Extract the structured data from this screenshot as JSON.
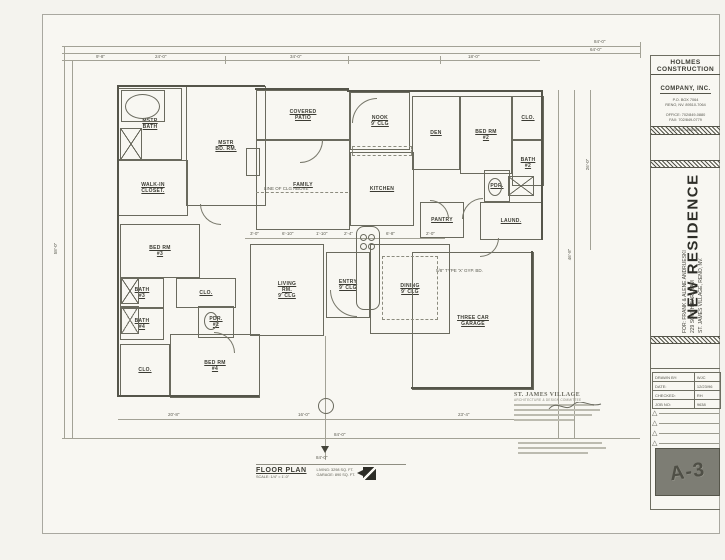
{
  "title_block": {
    "company_line1": "HOLMES CONSTRUCTION",
    "company_line2": "COMPANY, INC.",
    "addr1": "P.O. BOX 7064",
    "addr2": "RENO, NV. 89510-7064",
    "phone1": "OFFICE: 702/849-0880",
    "phone2": "FAX: 702/849-0779",
    "license": "NV. LIC. #38109",
    "project": "NEW RESIDENCE",
    "client": "FOR: FRANK & ALENE ANDRUESKI",
    "site_address": "229 SOUTH EARLHAM",
    "site_city": "ST. JAMES VILLAGE, RENO, NV.",
    "info_rows": [
      {
        "label": "DRAWN BY:",
        "value": "WJC"
      },
      {
        "label": "DATE:",
        "value": "12/23/96"
      },
      {
        "label": "CHECKED:",
        "value": "RH"
      },
      {
        "label": "JOB NO:",
        "value": "9638"
      }
    ],
    "sheet_number": "A-3"
  },
  "plan_title": {
    "name": "FLOOR PLAN",
    "scale": "SCALE: 1/4\" = 1'-0\"",
    "living_area": "LIVING:  3298 SQ. FT.",
    "garage_area": "GARAGE:  890 SQ. FT."
  },
  "stamp": {
    "title": "ST. JAMES VILLAGE",
    "subtitle": "ARCHITECTURE & DESIGN COMMITTEE"
  },
  "colors": {
    "ink": "#55554a",
    "paper": "#f8f7f2",
    "sheet_box": "#7d7d74"
  },
  "plan": {
    "rooms": [
      {
        "n": "mstr-bath",
        "t": "MSTR|BATH",
        "x": 118,
        "y": 88,
        "w": 62,
        "h": 70
      },
      {
        "n": "walk-in-closet",
        "t": "WALK-IN|CLOSET.",
        "x": 118,
        "y": 160,
        "w": 68,
        "h": 54
      },
      {
        "n": "mstr-bd-rm",
        "t": "MSTR|BD. RM.",
        "x": 186,
        "y": 86,
        "w": 78,
        "h": 118
      },
      {
        "n": "covered-patio",
        "t": "COVERED|PATIO",
        "x": 256,
        "y": 90,
        "w": 92,
        "h": 48
      },
      {
        "n": "family",
        "t": "FAMILY",
        "x": 256,
        "y": 140,
        "w": 92,
        "h": 88
      },
      {
        "n": "nook",
        "t": "NOOK|9' CLG",
        "x": 350,
        "y": 92,
        "w": 58,
        "h": 56
      },
      {
        "n": "den",
        "t": "DEN",
        "x": 412,
        "y": 96,
        "w": 46,
        "h": 72
      },
      {
        "n": "bed-rm-2",
        "t": "BED RM|#2",
        "x": 460,
        "y": 96,
        "w": 50,
        "h": 76
      },
      {
        "n": "clo-2",
        "t": "CLO.",
        "x": 512,
        "y": 96,
        "w": 30,
        "h": 42
      },
      {
        "n": "bath-2",
        "t": "BATH|#2",
        "x": 512,
        "y": 140,
        "w": 30,
        "h": 44
      },
      {
        "n": "pdr",
        "t": "PDR.",
        "x": 484,
        "y": 170,
        "w": 24,
        "h": 30
      },
      {
        "n": "laundry",
        "t": "LAUND.",
        "x": 480,
        "y": 202,
        "w": 60,
        "h": 36
      },
      {
        "n": "kitchen",
        "t": "KITCHEN",
        "x": 350,
        "y": 152,
        "w": 62,
        "h": 72
      },
      {
        "n": "pantry",
        "t": "PANTRY",
        "x": 420,
        "y": 202,
        "w": 42,
        "h": 34
      },
      {
        "n": "living-rm",
        "t": "LIVING|RM.|9' CLG",
        "x": 250,
        "y": 244,
        "w": 72,
        "h": 90
      },
      {
        "n": "entry",
        "t": "ENTRY|9' CLG",
        "x": 326,
        "y": 252,
        "w": 42,
        "h": 64
      },
      {
        "n": "dining",
        "t": "DINING|9' CLG",
        "x": 370,
        "y": 244,
        "w": 78,
        "h": 88
      },
      {
        "n": "bed-rm-3",
        "t": "BED RM|#3",
        "x": 120,
        "y": 224,
        "w": 78,
        "h": 52
      },
      {
        "n": "bath-3",
        "t": "BATH|#3",
        "x": 120,
        "y": 278,
        "w": 42,
        "h": 28
      },
      {
        "n": "hall-closet",
        "t": "CLO.",
        "x": 176,
        "y": 278,
        "w": 58,
        "h": 28
      },
      {
        "n": "bath-4",
        "t": "BATH|#4",
        "x": 120,
        "y": 308,
        "w": 42,
        "h": 30
      },
      {
        "n": "pdr-2",
        "t": "PDR.|#2",
        "x": 198,
        "y": 306,
        "w": 34,
        "h": 30
      },
      {
        "n": "closet-4",
        "t": "CLO.",
        "x": 120,
        "y": 344,
        "w": 48,
        "h": 50
      },
      {
        "n": "bed-rm-4",
        "t": "BED RM|#4",
        "x": 170,
        "y": 334,
        "w": 88,
        "h": 62
      },
      {
        "n": "three-car-garage",
        "t": "THREE CAR|GARAGE",
        "x": 412,
        "y": 252,
        "w": 120,
        "h": 136
      }
    ],
    "walls": [
      {
        "x": 117,
        "y": 85,
        "w": 2,
        "h": 312
      },
      {
        "x": 117,
        "y": 85,
        "w": 148,
        "h": 2
      },
      {
        "x": 255,
        "y": 88,
        "w": 94,
        "h": 2
      },
      {
        "x": 347,
        "y": 90,
        "w": 196,
        "h": 2
      },
      {
        "x": 541,
        "y": 90,
        "w": 2,
        "h": 150
      },
      {
        "x": 531,
        "y": 251,
        "w": 2,
        "h": 138
      },
      {
        "x": 411,
        "y": 387,
        "w": 122,
        "h": 2
      },
      {
        "x": 117,
        "y": 395,
        "w": 142,
        "h": 2
      }
    ],
    "dims": [
      {
        "x": 62,
        "y": 46,
        "w": 578,
        "h": 0
      },
      {
        "x": 62,
        "y": 53,
        "w": 578,
        "h": 0
      },
      {
        "x": 62,
        "y": 60,
        "w": 478,
        "h": 0
      },
      {
        "x": 245,
        "y": 238,
        "w": 200,
        "h": 0
      },
      {
        "x": 118,
        "y": 419,
        "w": 414,
        "h": 0
      },
      {
        "x": 62,
        "y": 438,
        "w": 578,
        "h": 0
      },
      {
        "x": 64,
        "y": 46,
        "w": 0,
        "h": 392
      },
      {
        "x": 72,
        "y": 60,
        "w": 0,
        "h": 378
      },
      {
        "x": 558,
        "y": 90,
        "w": 0,
        "h": 348
      },
      {
        "x": 574,
        "y": 90,
        "w": 0,
        "h": 348
      },
      {
        "x": 590,
        "y": 90,
        "w": 0,
        "h": 160
      },
      {
        "x": 640,
        "y": 42,
        "w": 0,
        "h": 16
      },
      {
        "x": 325,
        "y": 336,
        "w": 0,
        "h": 124
      },
      {
        "x": 225,
        "y": 56,
        "w": 0,
        "h": 8
      },
      {
        "x": 348,
        "y": 56,
        "w": 0,
        "h": 8
      },
      {
        "x": 440,
        "y": 56,
        "w": 0,
        "h": 8
      }
    ],
    "labels": [
      {
        "t": "84'-0\"",
        "x": 594,
        "y": 39
      },
      {
        "t": "64'-0\"",
        "x": 590,
        "y": 47
      },
      {
        "t": "9'-8\"",
        "x": 96,
        "y": 54
      },
      {
        "t": "24'-0\"",
        "x": 155,
        "y": 54
      },
      {
        "t": "34'-0\"",
        "x": 290,
        "y": 54
      },
      {
        "t": "18'-0\"",
        "x": 468,
        "y": 54
      },
      {
        "t": "3'-0\"",
        "x": 250,
        "y": 231
      },
      {
        "t": "6'-10\"",
        "x": 282,
        "y": 231
      },
      {
        "t": "1'-10\"",
        "x": 316,
        "y": 231
      },
      {
        "t": "2'-4\"",
        "x": 344,
        "y": 231
      },
      {
        "t": "6'-8\"",
        "x": 386,
        "y": 231
      },
      {
        "t": "2'-0\"",
        "x": 426,
        "y": 231
      },
      {
        "t": "20'-8\"",
        "x": 168,
        "y": 412
      },
      {
        "t": "16'-0\"",
        "x": 298,
        "y": 412
      },
      {
        "t": "23'-4\"",
        "x": 458,
        "y": 412
      },
      {
        "t": "84'-0\"",
        "x": 334,
        "y": 432
      },
      {
        "t": "58'-0\"",
        "x": 50,
        "y": 246,
        "r": -90
      },
      {
        "t": "46'-8\"",
        "x": 564,
        "y": 252,
        "r": -90
      },
      {
        "t": "26'-0\"",
        "x": 582,
        "y": 162,
        "r": -90
      },
      {
        "t": "LINE OF CLG ABOVE",
        "x": 264,
        "y": 186
      },
      {
        "t": "5/8\" TYPE 'X' GYP. BD.",
        "x": 436,
        "y": 268
      },
      {
        "t": "84'-0\"",
        "x": 316,
        "y": 455
      }
    ],
    "fixtures": [
      {
        "f": "rect",
        "x": 121,
        "y": 90,
        "w": 42,
        "h": 30,
        "n": "tub-deck"
      },
      {
        "f": "ellipse",
        "x": 125,
        "y": 94,
        "w": 33,
        "h": 23,
        "n": "master-tub"
      },
      {
        "f": "xbox",
        "x": 120,
        "y": 128,
        "w": 20,
        "h": 30,
        "n": "master-shower"
      },
      {
        "f": "xbox",
        "x": 121,
        "y": 278,
        "w": 16,
        "h": 24,
        "n": "shower-bath3"
      },
      {
        "f": "xbox",
        "x": 121,
        "y": 306,
        "w": 16,
        "h": 26,
        "n": "shower-bath4"
      },
      {
        "f": "xbox",
        "x": 508,
        "y": 176,
        "w": 24,
        "h": 18,
        "n": "shower-bath2"
      },
      {
        "f": "island",
        "x": 356,
        "y": 226,
        "w": 22,
        "h": 82,
        "n": "kitchen-island"
      },
      {
        "f": "circle",
        "x": 360,
        "y": 234,
        "w": 5,
        "h": 5,
        "n": "burner"
      },
      {
        "f": "circle",
        "x": 368,
        "y": 234,
        "w": 5,
        "h": 5,
        "n": "burner"
      },
      {
        "f": "circle",
        "x": 360,
        "y": 243,
        "w": 5,
        "h": 5,
        "n": "burner"
      },
      {
        "f": "circle",
        "x": 368,
        "y": 243,
        "w": 5,
        "h": 5,
        "n": "burner"
      },
      {
        "f": "dashrect",
        "x": 382,
        "y": 256,
        "w": 54,
        "h": 62,
        "n": "dining-ceiling-break"
      },
      {
        "f": "dashrect",
        "x": 352,
        "y": 146,
        "w": 58,
        "h": 8,
        "n": "upper-cabinets"
      },
      {
        "f": "dashline",
        "x": 256,
        "y": 192,
        "w": 92,
        "n": "ceiling-line"
      },
      {
        "f": "rect",
        "x": 246,
        "y": 148,
        "w": 12,
        "h": 26,
        "n": "fireplace"
      },
      {
        "f": "ellipse",
        "x": 488,
        "y": 178,
        "w": 12,
        "h": 16,
        "n": "toilet-pdr"
      },
      {
        "f": "ellipse",
        "x": 204,
        "y": 312,
        "w": 12,
        "h": 16,
        "n": "toilet-pdr2"
      },
      {
        "f": "arc",
        "x": 330,
        "y": 290,
        "w": 26,
        "h": 26,
        "q": "bl",
        "n": "entry-door-swing"
      },
      {
        "f": "arc",
        "x": 300,
        "y": 140,
        "w": 22,
        "h": 22,
        "q": "br",
        "n": "family-door-swing"
      },
      {
        "f": "arc",
        "x": 352,
        "y": 98,
        "w": 24,
        "h": 24,
        "q": "tl",
        "n": "nook-arch"
      },
      {
        "f": "arc",
        "x": 430,
        "y": 200,
        "w": 18,
        "h": 18,
        "q": "tr",
        "n": "den-door-swing"
      },
      {
        "f": "arc",
        "x": 462,
        "y": 198,
        "w": 20,
        "h": 20,
        "q": "tl",
        "n": "bed2-door-swing"
      },
      {
        "f": "arc",
        "x": 200,
        "y": 204,
        "w": 20,
        "h": 20,
        "q": "bl",
        "n": "mstr-door-swing"
      },
      {
        "f": "arc",
        "x": 214,
        "y": 332,
        "w": 20,
        "h": 20,
        "q": "tr",
        "n": "bed4-door-swing"
      },
      {
        "f": "arc",
        "x": 480,
        "y": 238,
        "w": 18,
        "h": 18,
        "q": "br",
        "n": "laundry-door-swing"
      },
      {
        "f": "circle",
        "x": 318,
        "y": 398,
        "w": 14,
        "h": 14,
        "n": "section-marker"
      },
      {
        "f": "tri",
        "x": 321,
        "y": 446,
        "w": 0,
        "h": 0,
        "n": "marker-arrow"
      }
    ]
  }
}
